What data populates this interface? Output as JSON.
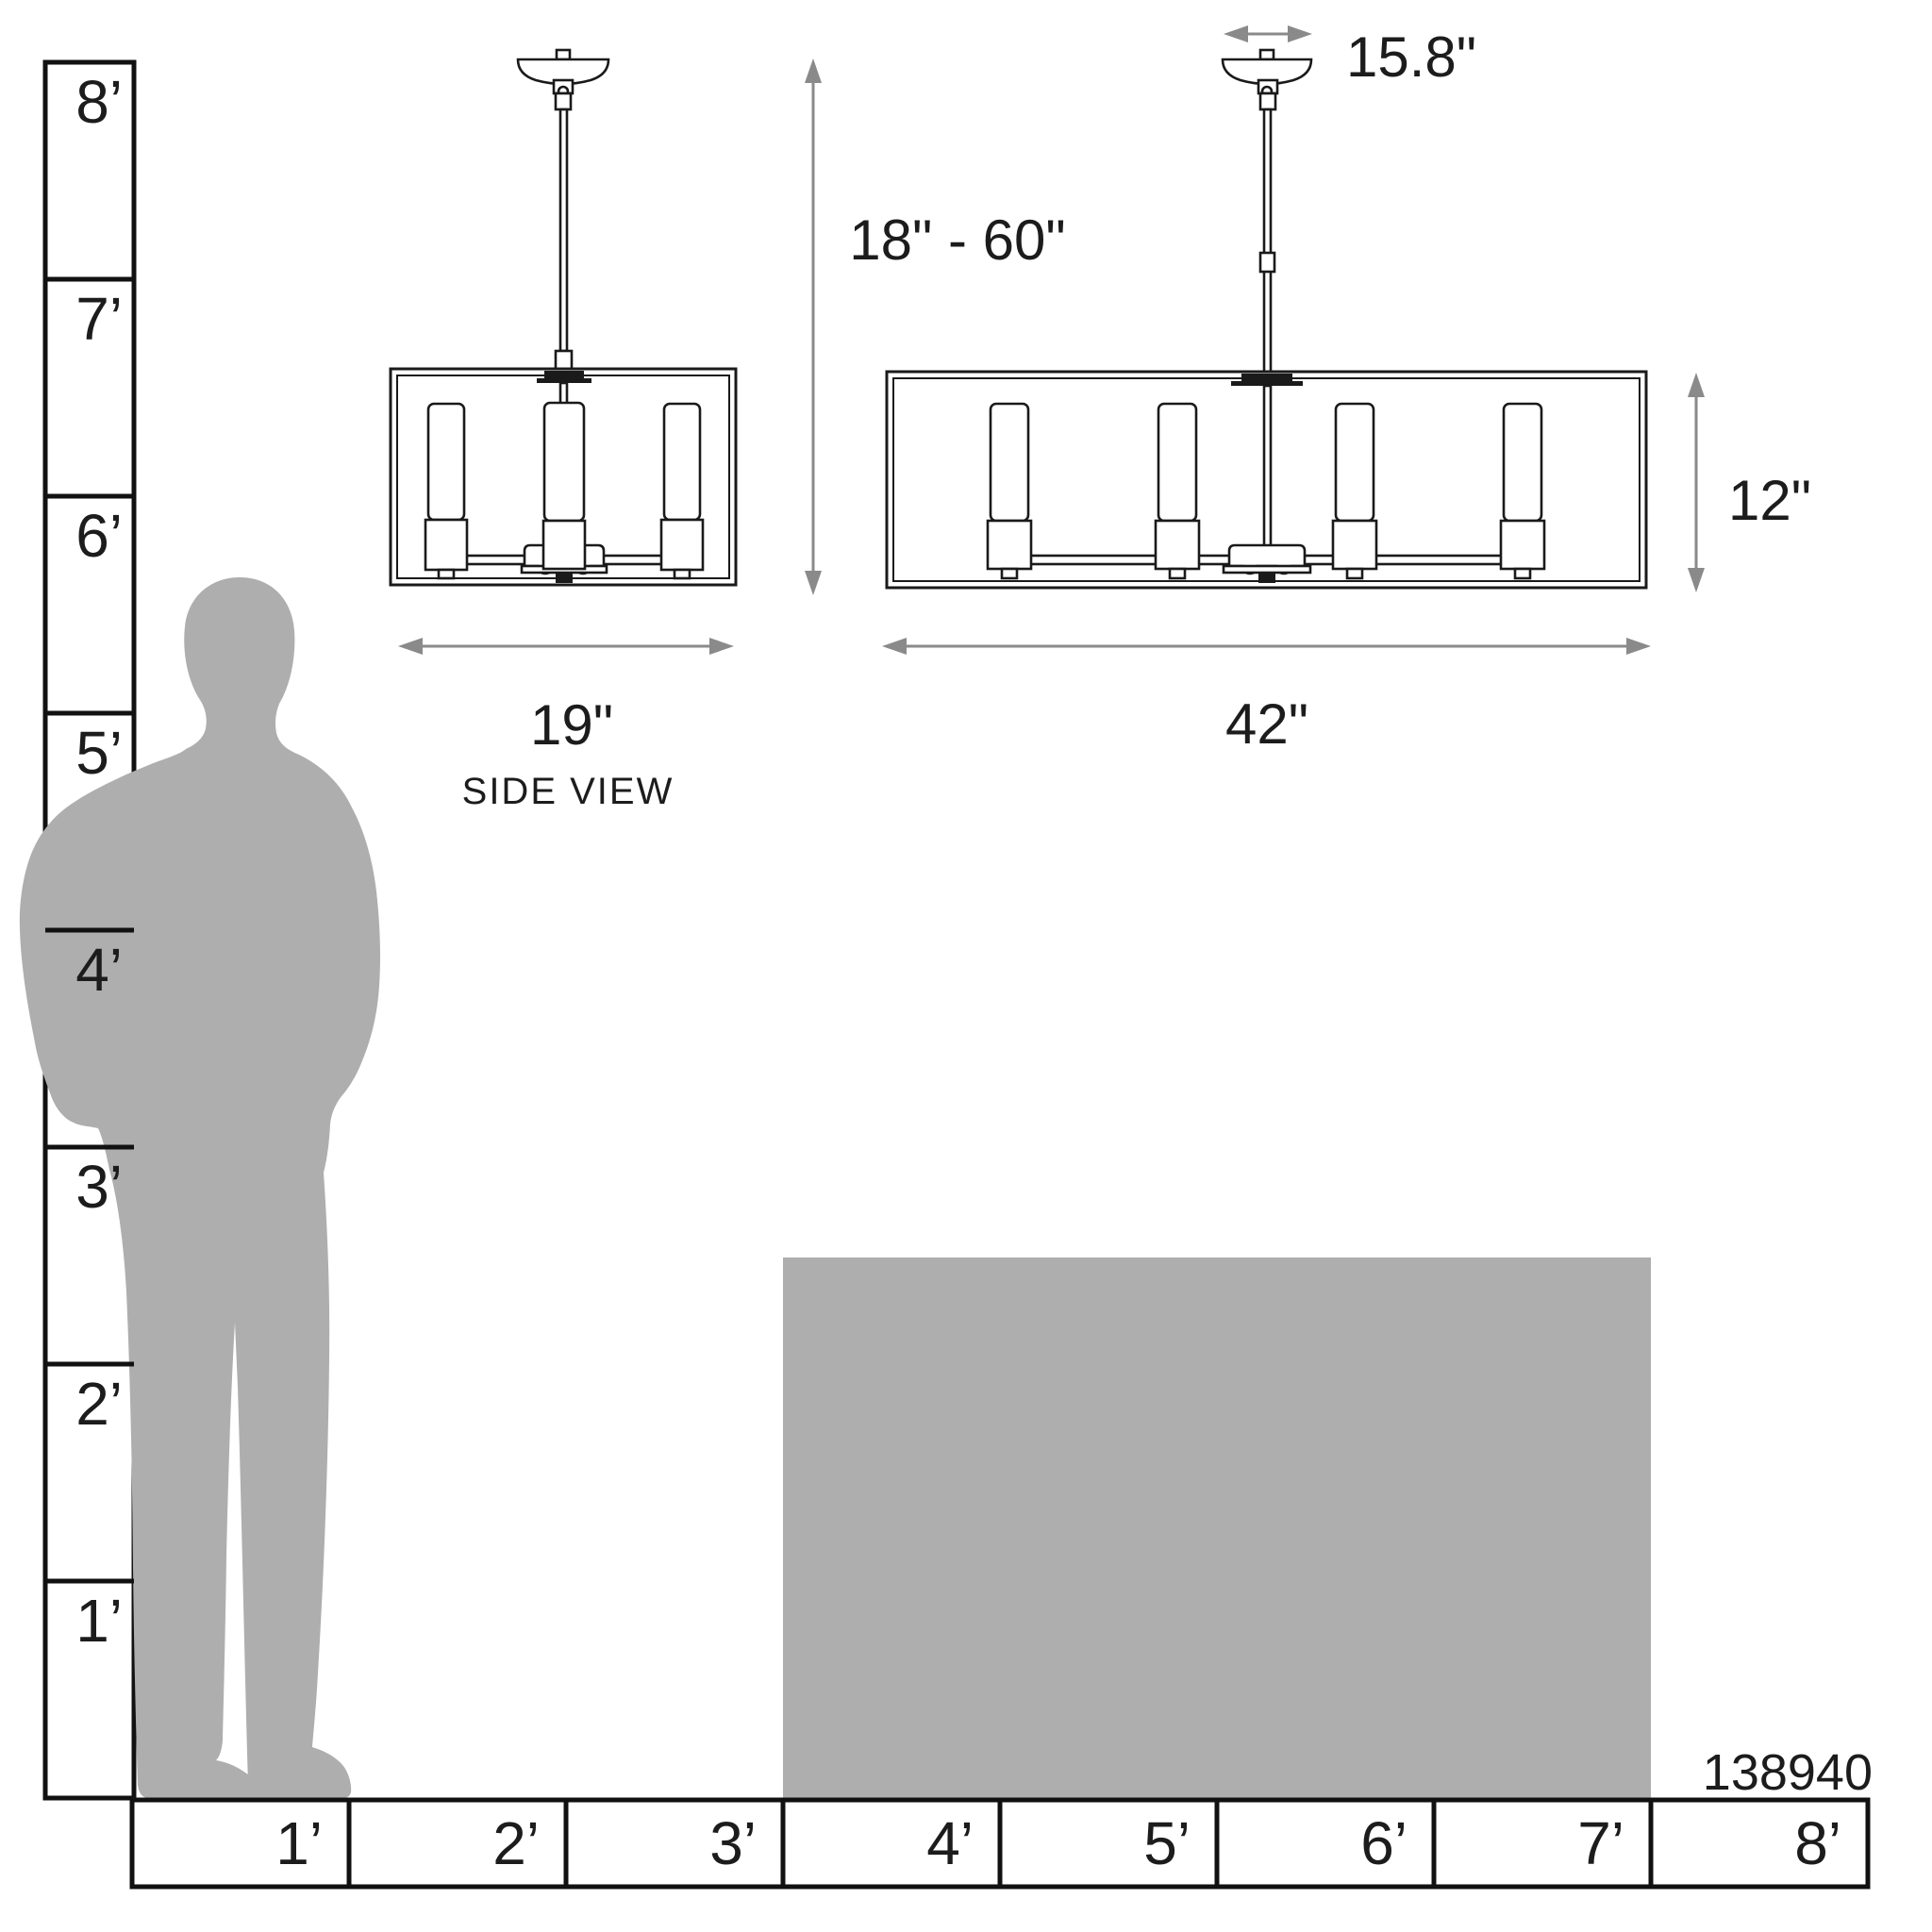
{
  "left_ruler": {
    "labels": [
      "8’",
      "7’",
      "6’",
      "5’",
      "4’",
      "3’",
      "2’",
      "1’"
    ]
  },
  "bottom_ruler": {
    "labels": [
      "1’",
      "2’",
      "3’",
      "4’",
      "5’",
      "6’",
      "7’",
      "8’"
    ]
  },
  "dimensions": {
    "side_width": "19\"",
    "side_caption": "SIDE VIEW",
    "hang_height": "18\" - 60\"",
    "canopy_width": "15.8\"",
    "front_width": "42\"",
    "shade_height": "12\""
  },
  "product_code": "138940",
  "colors": {
    "silhouette_gray": "#aeaeae",
    "island_gray": "#aeaeae",
    "arrow_gray": "#8a8a8a",
    "line_black": "#111111"
  }
}
